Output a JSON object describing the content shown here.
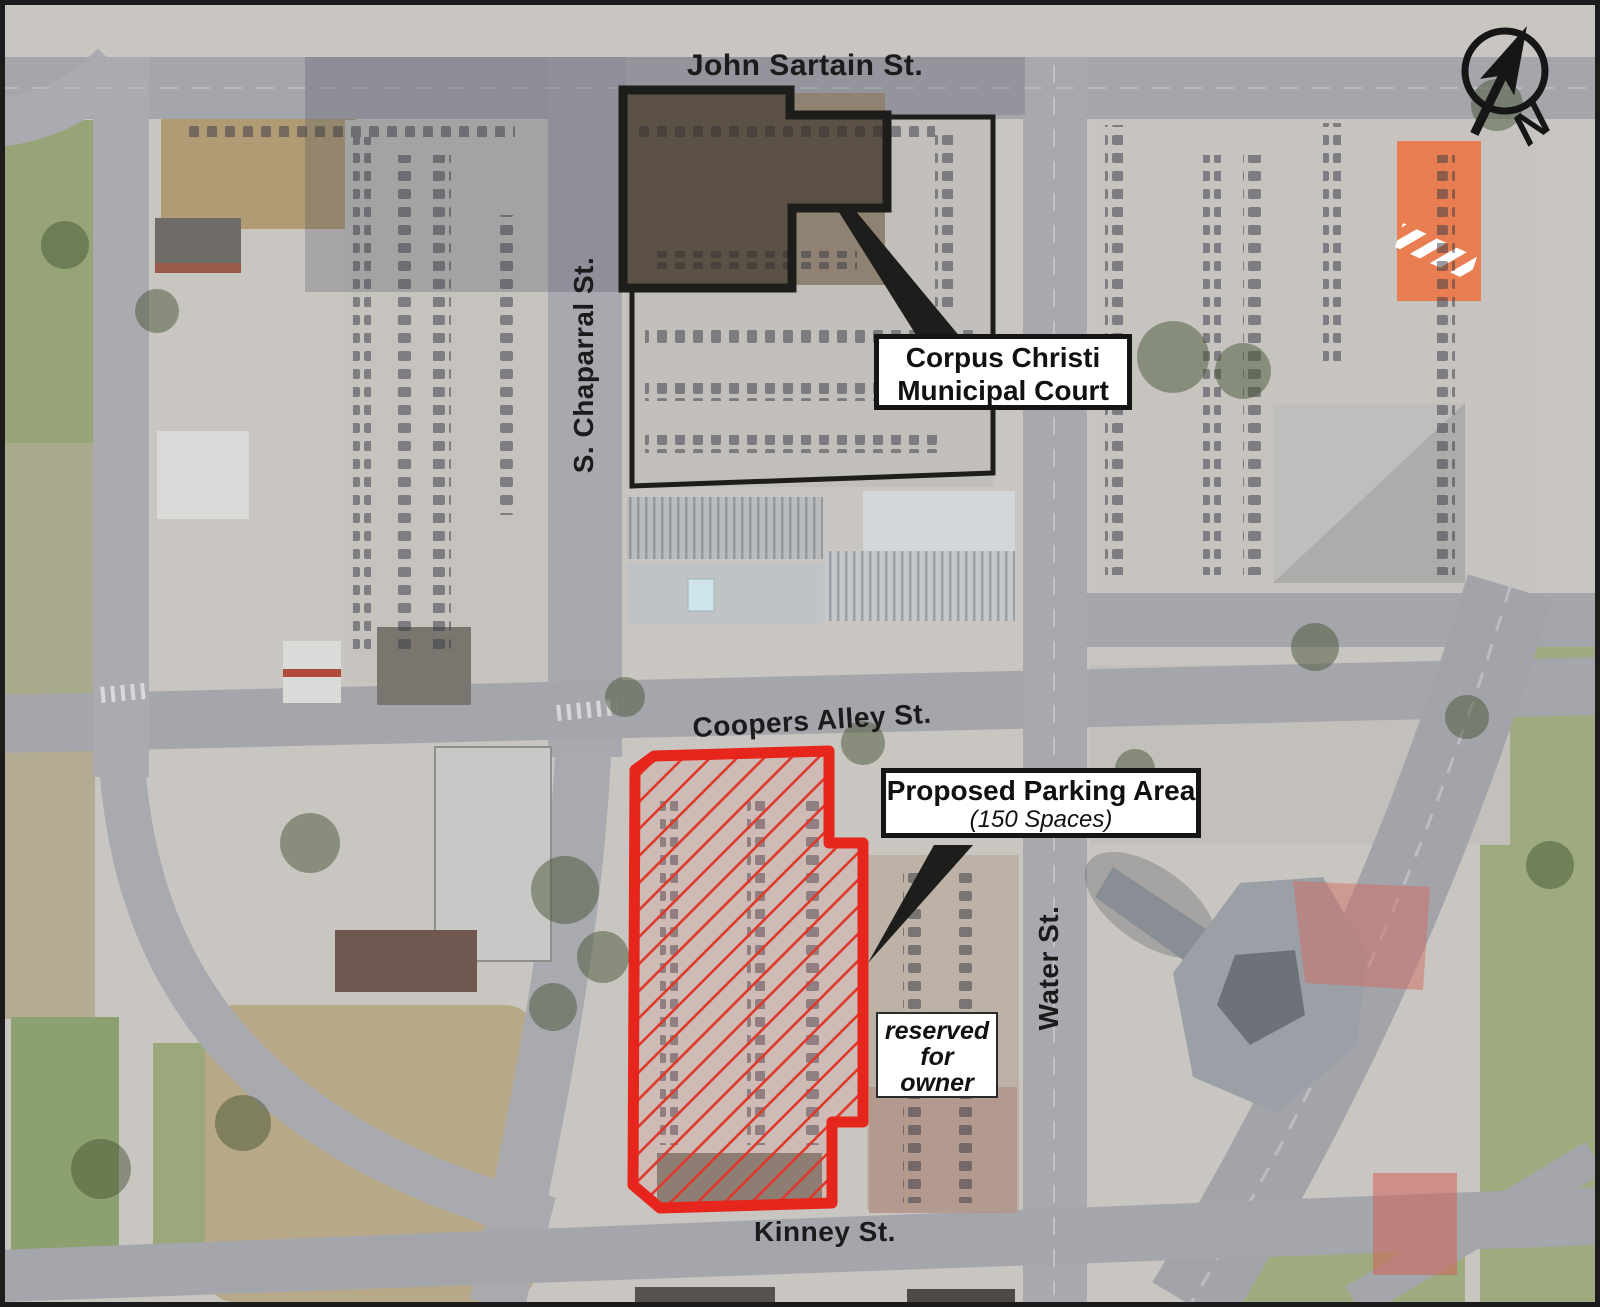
{
  "streets": {
    "john_sartain": "John Sartain St.",
    "s_chaparral": "S. Chaparral St.",
    "coopers_alley": "Coopers Alley St.",
    "water": "Water St.",
    "kinney": "Kinney St."
  },
  "callouts": {
    "court": {
      "line1": "Corpus Christi",
      "line2": "Municipal Court"
    },
    "parking": {
      "title": "Proposed Parking Area",
      "subtitle": "(150 Spaces)"
    },
    "reserved": {
      "line1": "reserved",
      "line2": "for",
      "line3": "owner"
    }
  },
  "north_arrow": {
    "label": "N"
  },
  "colors": {
    "parcel_outline": "#e6251c",
    "hatch_line": "#dd392d",
    "building_outline": "#1d1d1b",
    "callout_outline": "#151515",
    "callout_background": "#ffffff"
  }
}
